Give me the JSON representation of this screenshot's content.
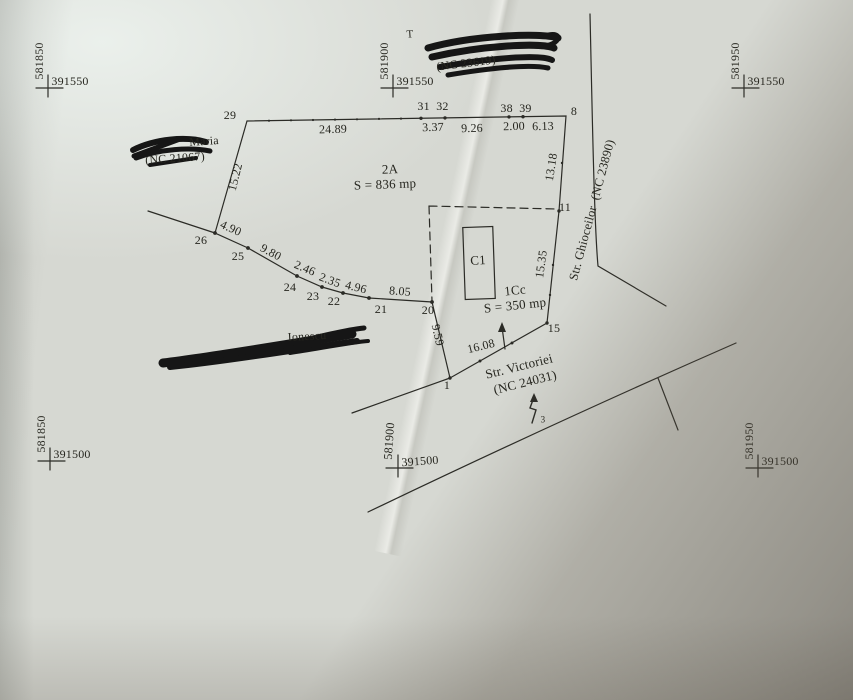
{
  "grid": {
    "tl": {
      "e": "581850",
      "n": "391550"
    },
    "tc": {
      "e": "581900",
      "n": "391550"
    },
    "tr": {
      "e": "581950",
      "n": "391550"
    },
    "bl": {
      "e": "581850",
      "n": "391500"
    },
    "bc": {
      "e": "581900",
      "n": "391500"
    },
    "br": {
      "e": "581950",
      "n": "391500"
    }
  },
  "points": {
    "p29": "29",
    "p3132": "31  32",
    "p3839": "38  39",
    "p8": "8",
    "p26": "26",
    "p25": "25",
    "p24": "24",
    "p23": "23",
    "p22": "22",
    "p21": "21",
    "p20": "20",
    "p11": "11",
    "p15": "15",
    "p1": "1"
  },
  "distances": {
    "top1": "24.89",
    "top2": "3.37",
    "top3": "9.26",
    "top4": "2.00",
    "top5": "6.13",
    "left": "15.22",
    "s1": "4.90",
    "s2": "9.80",
    "s3": "2.46",
    "s4": "2.35",
    "s5": "4.96",
    "s6": "8.05",
    "right1": "13.18",
    "right2": "15.35",
    "low1": "9.59",
    "low2": "16.08"
  },
  "parcels": {
    "p2a_name": "2A",
    "p2a_area": "S = 836 mp",
    "c1": "C1",
    "p1cc_name": "1Cc",
    "p1cc_area": "S = 350 mp"
  },
  "streets": {
    "ghioceilor": "Str. Ghioceilor  (NC 23890)",
    "victoriei1": "Str. Victoriei",
    "victoriei2": "(NC 24031)"
  },
  "neighbors": {
    "north_fragment": "T",
    "north_nc": "(NC 23619)",
    "west_name": "Maria",
    "west_nc": "(NC 21067)",
    "south_name": "Ionescu"
  },
  "symbols": {
    "pole_number": "3"
  }
}
